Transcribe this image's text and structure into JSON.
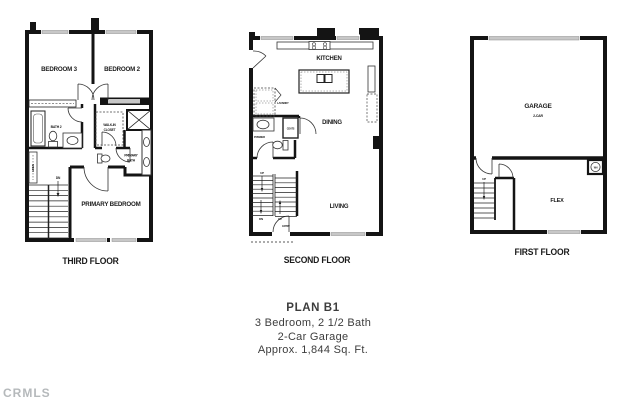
{
  "watermark": "CRMLS",
  "caption": {
    "title": "PLAN B1",
    "subtitle1": "3 Bedroom, 2 1/2 Bath",
    "subtitle2": "2-Car Garage",
    "subtitle3": "Approx. 1,844 Sq. Ft."
  },
  "colors": {
    "wall": "#141414",
    "window_glass": "#c7c7c7",
    "label_text": "#1b1b1b",
    "caption_text": "#3d3d3d",
    "watermark_text": "#a9adb0"
  },
  "floors": {
    "third": {
      "label": "THIRD FLOOR",
      "rooms": {
        "bedroom3": "BEDROOM 3",
        "bedroom2": "BEDROOM 2",
        "bath2": "BATH 2",
        "walkin1": "WALK-IN",
        "walkin2": "CLOSET",
        "primary_bath1": "PRIMARY",
        "primary_bath2": "BATH",
        "linen": "LINEN",
        "dn": "DN",
        "primary_bedroom": "PRIMARY BEDROOM"
      }
    },
    "second": {
      "label": "SECOND FLOOR",
      "rooms": {
        "kitchen": "KITCHEN",
        "laundry": "LAUNDRY",
        "coats": "COATS",
        "powder": "POWDER",
        "dining": "DINING",
        "living": "LIVING",
        "up_top": "UP",
        "dn": "DN",
        "up_bottom": "UP",
        "entry": "ENTRY"
      }
    },
    "first": {
      "label": "FIRST FLOOR",
      "rooms": {
        "garage": "GARAGE",
        "garage_type": "2-CAR",
        "up": "UP",
        "wh": "WH",
        "flex": "FLEX"
      }
    }
  }
}
